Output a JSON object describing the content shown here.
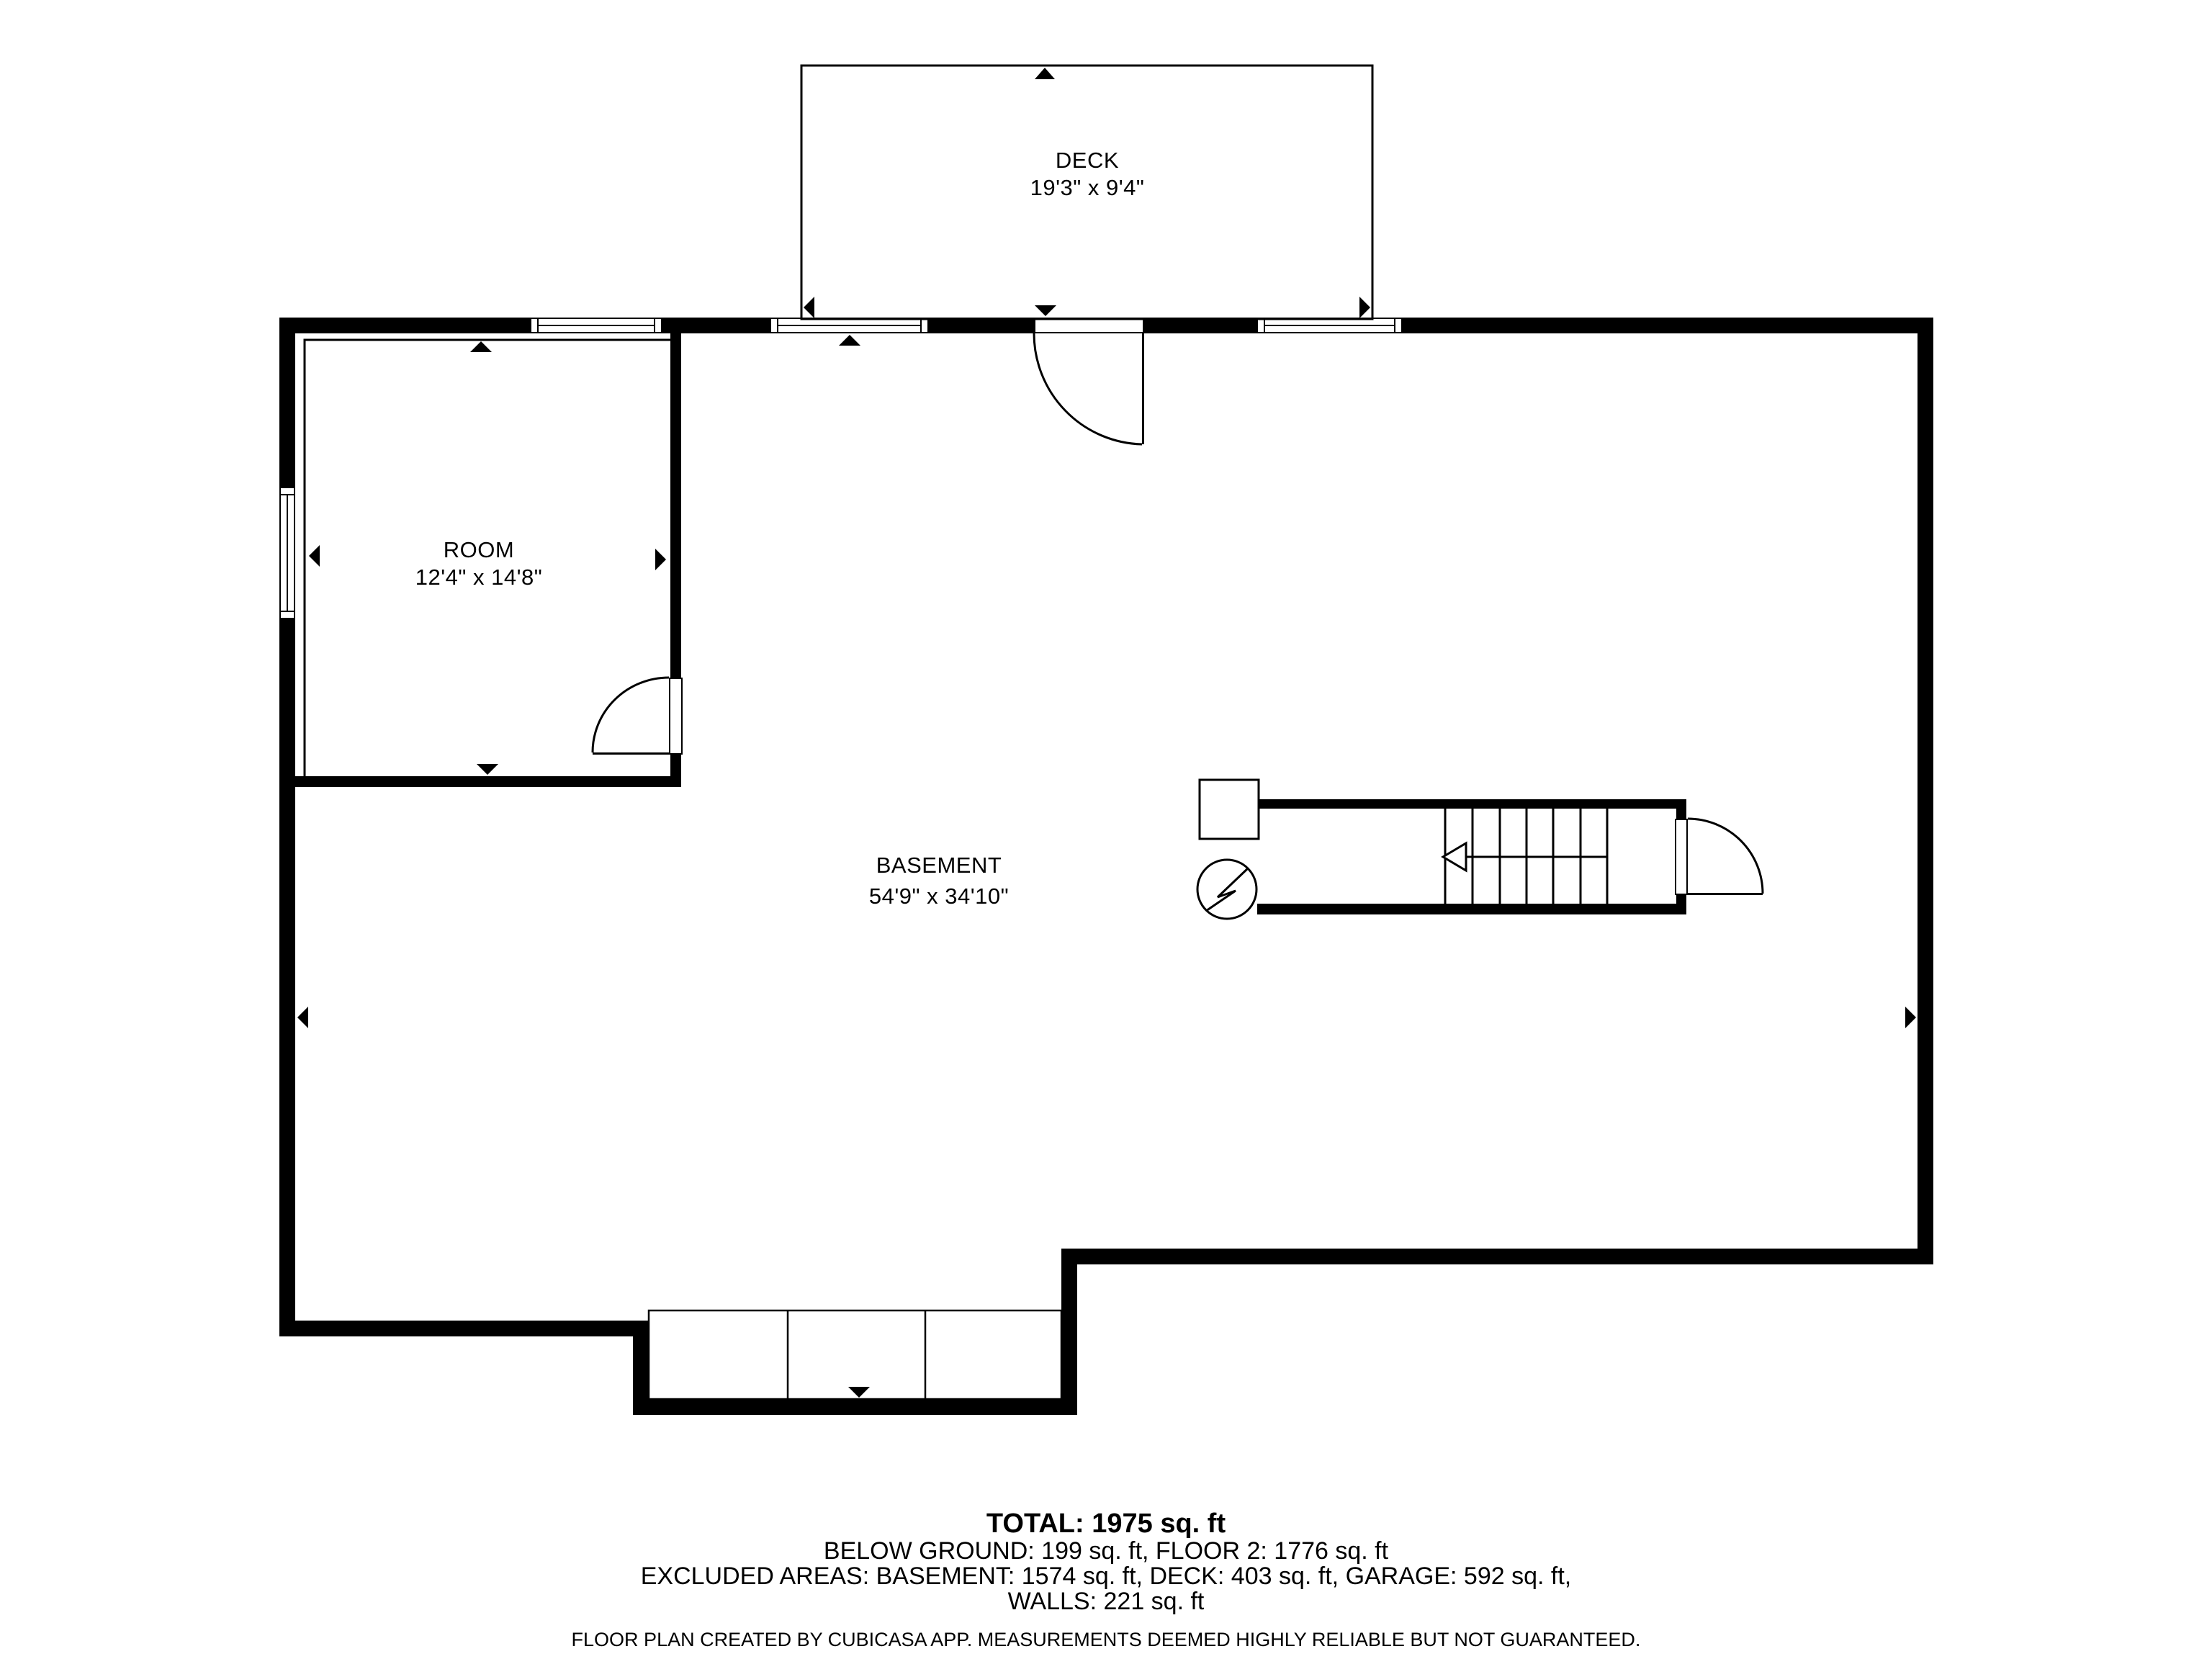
{
  "colors": {
    "wall": "#000000",
    "background": "#ffffff",
    "text": "#000000"
  },
  "rooms": {
    "deck": {
      "name": "DECK",
      "dimensions": "19'3\" x 9'4\""
    },
    "room": {
      "name": "ROOM",
      "dimensions": "12'4\" x 14'8\""
    },
    "basement": {
      "name": "BASEMENT",
      "dimensions": "54'9\" x 34'10\""
    }
  },
  "summary": {
    "total": "TOTAL: 1975 sq. ft",
    "below_ground": "BELOW GROUND: 199 sq. ft, FLOOR 2: 1776 sq. ft",
    "excluded": "EXCLUDED AREAS: BASEMENT: 1574 sq. ft, DECK: 403 sq. ft, GARAGE: 592 sq. ft,",
    "walls": "WALLS: 221 sq. ft"
  },
  "footer": "FLOOR PLAN CREATED BY CUBICASA APP. MEASUREMENTS DEEMED HIGHLY RELIABLE BUT NOT GUARANTEED."
}
